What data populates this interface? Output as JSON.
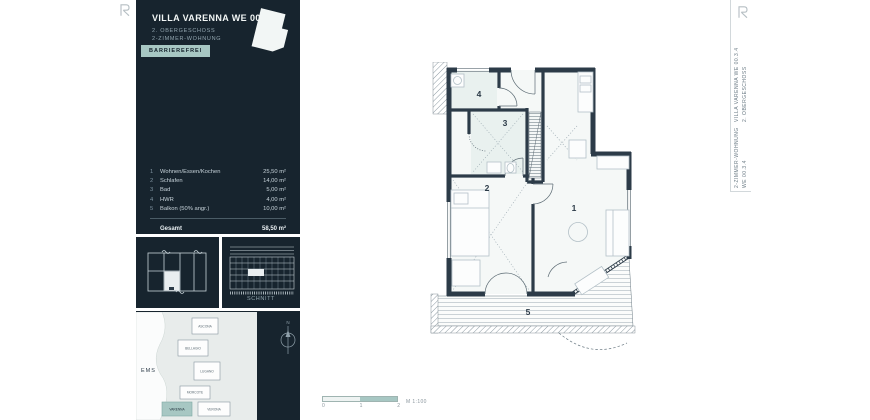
{
  "header": {
    "title": "VILLA VARENNA WE 00.3.4",
    "subtitle1": "2. OBERGESCHOSS",
    "subtitle2": "2-ZIMMER-WOHNUNG",
    "badge": "BARRIEREFREI"
  },
  "room_table": {
    "rows": [
      {
        "num": "1",
        "label": "Wohnen/Essen/Kochen",
        "area": "25,50 m²"
      },
      {
        "num": "2",
        "label": "Schlafen",
        "area": "14,00 m²"
      },
      {
        "num": "3",
        "label": "Bad",
        "area": "5,00 m²"
      },
      {
        "num": "4",
        "label": "HWR",
        "area": "4,00 m²"
      },
      {
        "num": "5",
        "label": "Balkon (50% angr.)",
        "area": "10,00 m²"
      }
    ],
    "total_label": "Gesamt",
    "total_area": "58,50 m²"
  },
  "minis": {
    "section_caption": "Schnitt"
  },
  "siteplan": {
    "river": "EMS",
    "compass": "N",
    "buildings": [
      "ASCONA",
      "BELLAGIO",
      "LUGANO",
      "MORCOTE",
      "VARENNA",
      "VERONA"
    ],
    "highlighted": "VARENNA"
  },
  "plan": {
    "rooms": [
      "1",
      "2",
      "3",
      "4",
      "5"
    ]
  },
  "scalebar": {
    "t0": "0",
    "t1": "1",
    "t2": "2",
    "label": "M 1:100"
  },
  "titleblock": {
    "block1_line1": "VILLA VARENNA WE 00.3.4",
    "block1_line2": "2. OBERGESCHOSS",
    "block2_line1": "2-ZIMMER-WOHNUNG",
    "block2_line2": "WE 00.3.4"
  },
  "icons": {
    "brand_mark": "R-monogram",
    "compass": "compass-north"
  },
  "colors": {
    "navy": "#17242e",
    "wall": "#2c3b48",
    "teal": "#a7c7c3",
    "site_bg": "#e8eceb"
  }
}
